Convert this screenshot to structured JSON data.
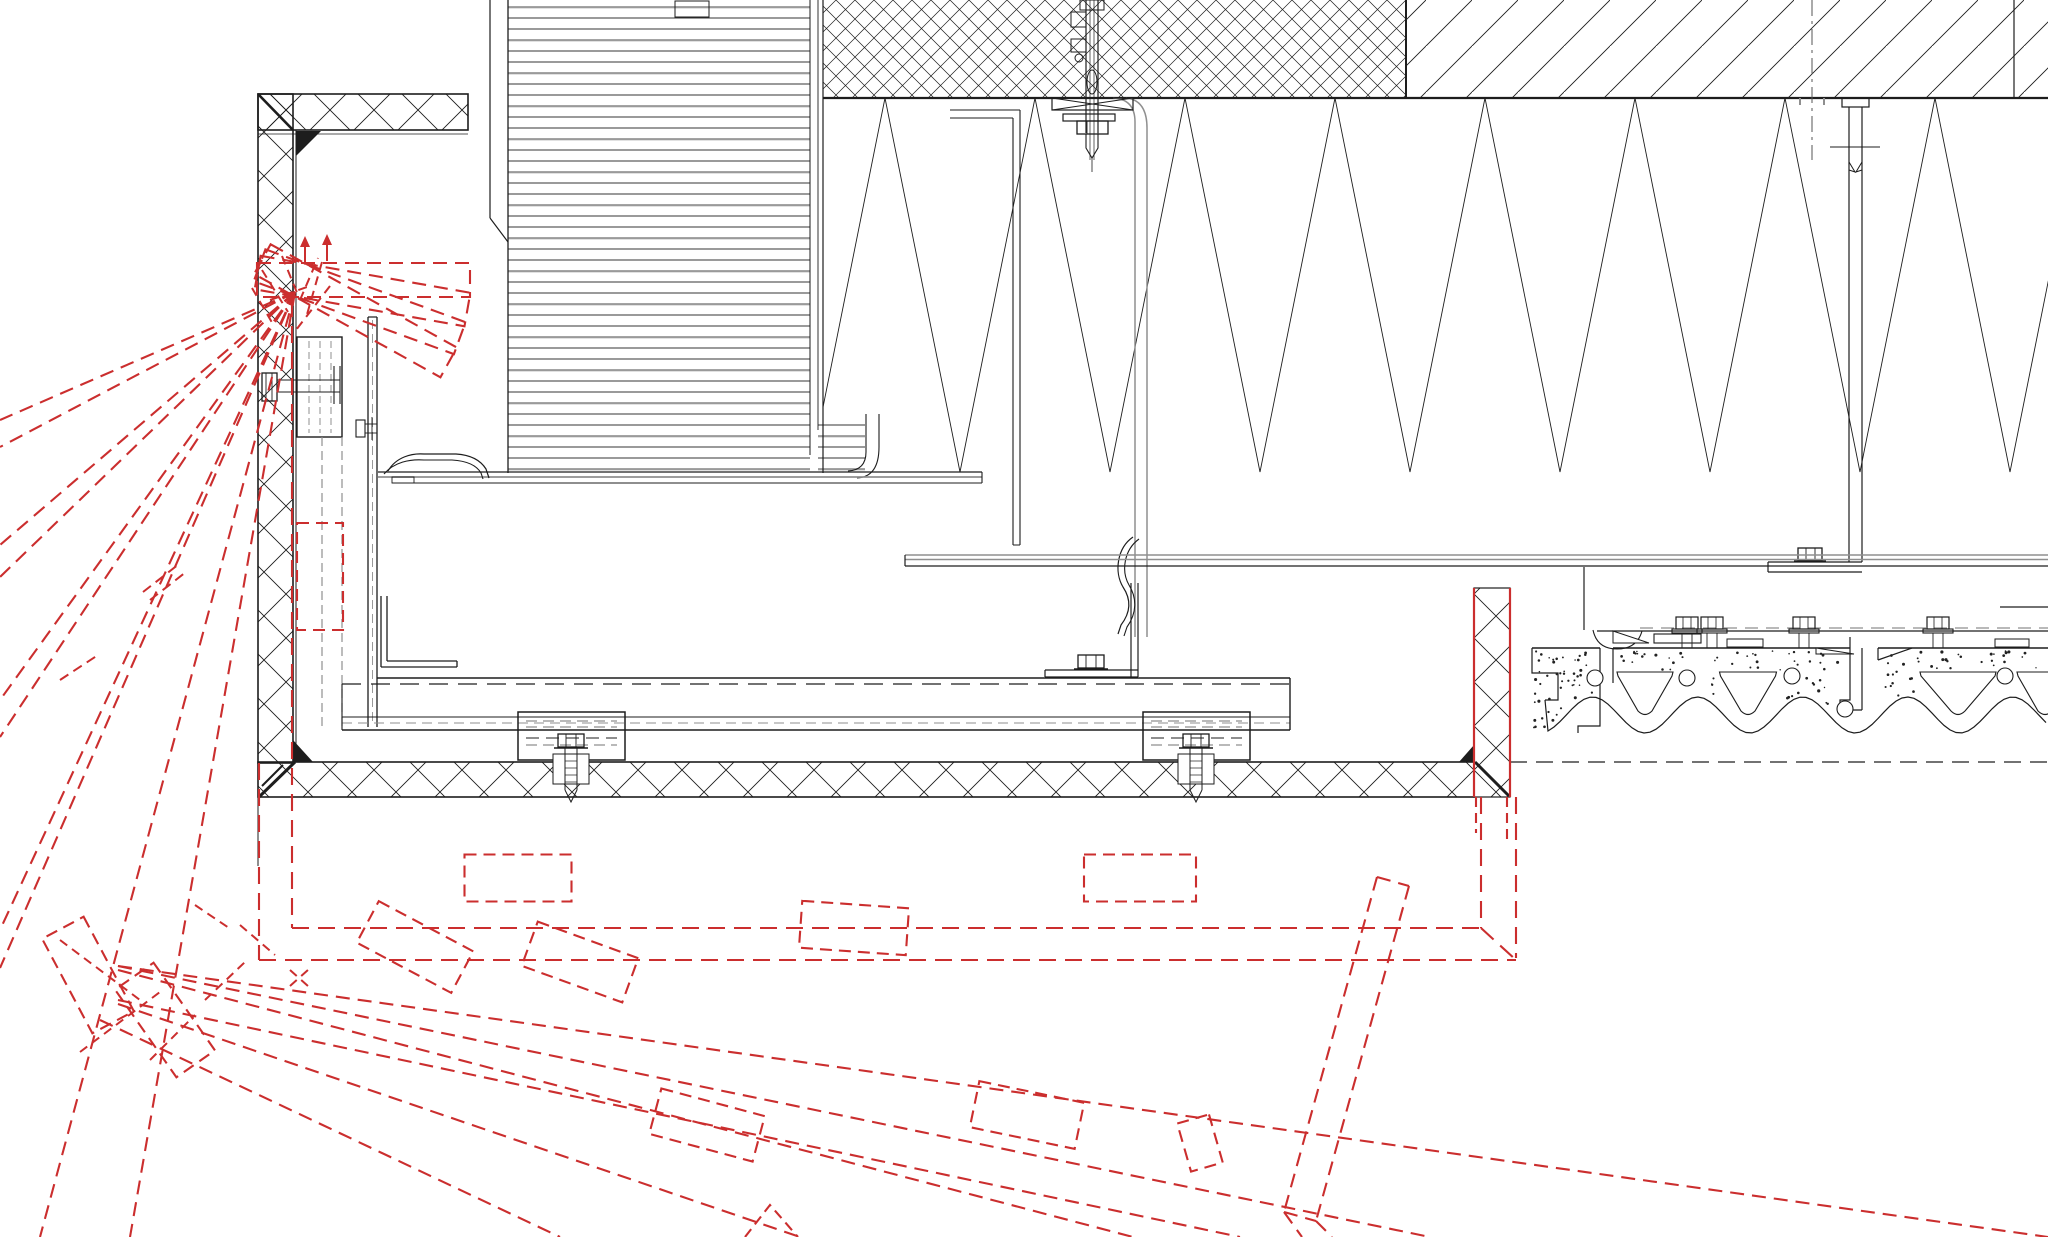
{
  "meta": {
    "kind": "cad-construction-detail",
    "description": "Architectural CAD section detail of a soffit-mounted ventilation flap: insulated L-frame, louvre stack, mineral-wool zig-zag insulation, hollow precast concrete deck, fixing bolts, and red dashed flap opening-swing positions.",
    "visible_text": ""
  },
  "colors": {
    "ink": "#1d1d1d",
    "gray": "#8f8f8f",
    "lightgray": "#b9b9b9",
    "red": "#cb2e2e",
    "background": "#ffffff"
  },
  "annotations": {
    "wall": "insulated frame section (cross-hatch)",
    "mesh": "dense panel block (fine cross-hatch)",
    "diag": "topping layer (diagonal hatch)",
    "zigzag": "mineral wool insulation (zig-zag band)",
    "louvre": "ventilation louvre stack",
    "flap_frame": "flap frame and bottom channel",
    "clamps": "clamp blocks with anchor bolts",
    "mid_hanger": "suspended hanger bracket with spring clip",
    "anchor": "ceiling anchor bolt",
    "right_hanger": "rear hanger bracket",
    "rails": "support rails",
    "deck": "precast hollow concrete deck",
    "red_overlay": "flap swing positions (dashed red)"
  },
  "zigzag": {
    "x_min": 823,
    "x_max": 2048,
    "top_y": 98,
    "bottom_y": 472,
    "first_top_x": 885,
    "period": 150
  },
  "louvre": {
    "x": 508,
    "right": 810,
    "bottom": 473,
    "pitch": 11
  },
  "deck": {
    "x0": 1532,
    "x1": 2048,
    "top_y": 648,
    "bolts_x": [
      1687,
      1712,
      1804,
      1938
    ],
    "holes": [
      [
        1595,
        678
      ],
      [
        1687,
        678
      ],
      [
        1792,
        676
      ],
      [
        2005,
        676
      ],
      [
        1845,
        709
      ]
    ],
    "hole_r": 8,
    "voids": [
      [
        1645,
        56
      ],
      [
        1748,
        57
      ],
      [
        1958,
        76
      ],
      [
        2045,
        56
      ]
    ],
    "wave": {
      "start": 1540,
      "period": 105,
      "mid": 715,
      "amp": 18
    },
    "speckle_tries": 430
  },
  "clamp_bolts_x": [
    571,
    1196
  ],
  "red": {
    "pivot_top": [
      300,
      280
    ],
    "cap_rect": [
      257,
      263,
      213,
      34
    ],
    "cap_angles": [
      0,
      10,
      20,
      29
    ],
    "arrows": [
      [
        305,
        263,
        305,
        242
      ],
      [
        327,
        261,
        327,
        240
      ]
    ],
    "top_cluster": [
      [
        282,
        256,
        300,
        300
      ],
      [
        300,
        300,
        318,
        258
      ],
      [
        262,
        270,
        288,
        312
      ],
      [
        322,
        262,
        306,
        318
      ],
      [
        270,
        300,
        310,
        286
      ],
      [
        330,
        286,
        296,
        330
      ],
      [
        252,
        288,
        274,
        326
      ]
    ],
    "fan_top": [
      [
        295,
        292,
        0,
        420
      ],
      [
        295,
        292,
        0,
        447
      ],
      [
        295,
        292,
        0,
        545
      ],
      [
        295,
        292,
        0,
        577
      ],
      [
        295,
        292,
        0,
        700
      ],
      [
        295,
        292,
        0,
        737
      ],
      [
        295,
        292,
        0,
        930
      ],
      [
        295,
        292,
        0,
        968
      ],
      [
        295,
        292,
        40,
        1237
      ],
      [
        295,
        292,
        130,
        1237
      ]
    ],
    "cap_stubs": [
      [
        150,
        600,
        186,
        572
      ],
      [
        143,
        592,
        179,
        564
      ],
      [
        60,
        680,
        98,
        655
      ]
    ],
    "wall_rect": [
      297,
      523,
      46,
      107
    ],
    "closed_lines": [
      [
        292,
        928,
        1481,
        928
      ],
      [
        259,
        960,
        1516,
        960
      ],
      [
        1481,
        797,
        1481,
        928
      ],
      [
        1516,
        797,
        1516,
        958
      ],
      [
        1481,
        928,
        1516,
        960
      ],
      [
        259,
        763,
        259,
        960
      ],
      [
        292,
        300,
        292,
        928
      ]
    ],
    "closed_rects": [
      [
        518,
        878,
        107,
        47,
        0
      ],
      [
        1140,
        878,
        112,
        47,
        0
      ]
    ],
    "bar_edges": [
      [
        1474,
        588,
        1474,
        797
      ],
      [
        1510,
        588,
        1510,
        797
      ]
    ],
    "bar_edge_tails": [
      [
        1476,
        797,
        1476,
        833
      ],
      [
        1507,
        797,
        1507,
        840
      ]
    ],
    "fan_bottom": [
      [
        118,
        966,
        2048,
        1237
      ],
      [
        118,
        966,
        1430,
        1237
      ],
      [
        118,
        1000,
        1240,
        1237
      ],
      [
        118,
        970,
        1133,
        1237
      ],
      [
        118,
        1004,
        800,
        1237
      ],
      [
        100,
        1020,
        560,
        1237
      ]
    ],
    "bottom_rects": [
      [
        1027,
        1115,
        107,
        47,
        11.7
      ],
      [
        707,
        1125,
        107,
        47,
        15
      ],
      [
        854,
        928,
        107,
        47,
        4
      ],
      [
        580,
        962,
        107,
        47,
        20
      ],
      [
        415,
        947,
        107,
        47,
        28
      ],
      [
        88,
        975,
        107,
        47,
        62
      ],
      [
        165,
        1020,
        107,
        47,
        55
      ],
      [
        1200,
        1143,
        50,
        33,
        74
      ]
    ],
    "steep_band": [
      [
        1377,
        877,
        1284,
        1212
      ],
      [
        1409,
        886,
        1316,
        1221
      ],
      [
        1377,
        877,
        1409,
        886
      ],
      [
        1284,
        1212,
        1316,
        1221
      ],
      [
        1284,
        1212,
        1302,
        1237
      ],
      [
        1316,
        1221,
        1332,
        1237
      ]
    ],
    "bottom_cluster": [
      [
        60,
        940,
        140,
        1000
      ],
      [
        80,
        1052,
        160,
        992
      ],
      [
        195,
        905,
        232,
        930
      ],
      [
        290,
        970,
        308,
        986
      ],
      [
        290,
        986,
        308,
        970
      ],
      [
        240,
        925,
        275,
        955
      ],
      [
        205,
        1000,
        245,
        962
      ],
      [
        150,
        1060,
        195,
        1015
      ]
    ],
    "chevrons": [
      [
        745,
        1237,
        770,
        1205,
        798,
        1237
      ]
    ]
  }
}
